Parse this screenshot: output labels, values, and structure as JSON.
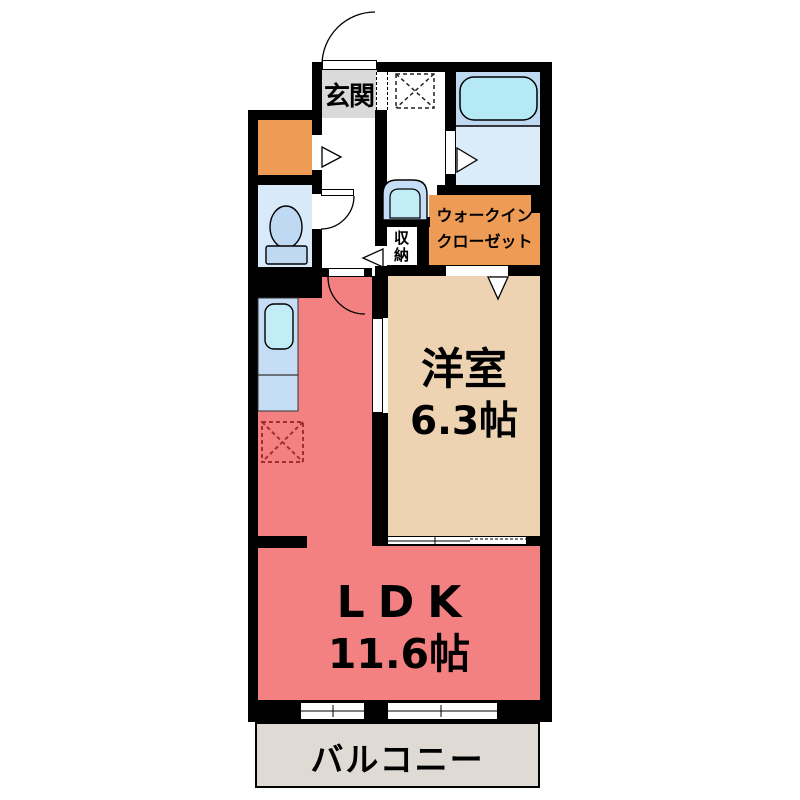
{
  "floorplan": {
    "entrance": {
      "label": "玄関"
    },
    "living": {
      "label": "LDK",
      "size": "11.6帖"
    },
    "western_room": {
      "label": "洋室",
      "size": "6.3帖"
    },
    "walk_in_closet": {
      "line1": "ウォークイン",
      "line2": "クローゼット"
    },
    "storage": {
      "label": "収納"
    },
    "balcony": {
      "label": "バルコニー"
    },
    "fixtures": [
      "bathtub",
      "washing-machine-area",
      "washbasin",
      "toilet",
      "kitchen-counter",
      "kitchen-sink",
      "refrigerator-area",
      "entrance-door",
      "toilet-door",
      "ldk-door",
      "bathroom-door",
      "closet-door"
    ],
    "colors": {
      "wall": "#000000",
      "ldk_floor": "#F48181",
      "western_room_floor": "#EDD3B2",
      "closet_floor": "#EE9C55",
      "entrance_floor": "#DADADA",
      "balcony_floor": "#DFDBD4",
      "bath_floor": "#DCEBF8",
      "bath_tub_zone": "#BED9F0",
      "toilet_floor": "#D8E9FA",
      "fixture_blue": "#C3EDF6",
      "counter_blue": "#C6DEF5",
      "refrigerator_mark": "#A03030"
    }
  }
}
